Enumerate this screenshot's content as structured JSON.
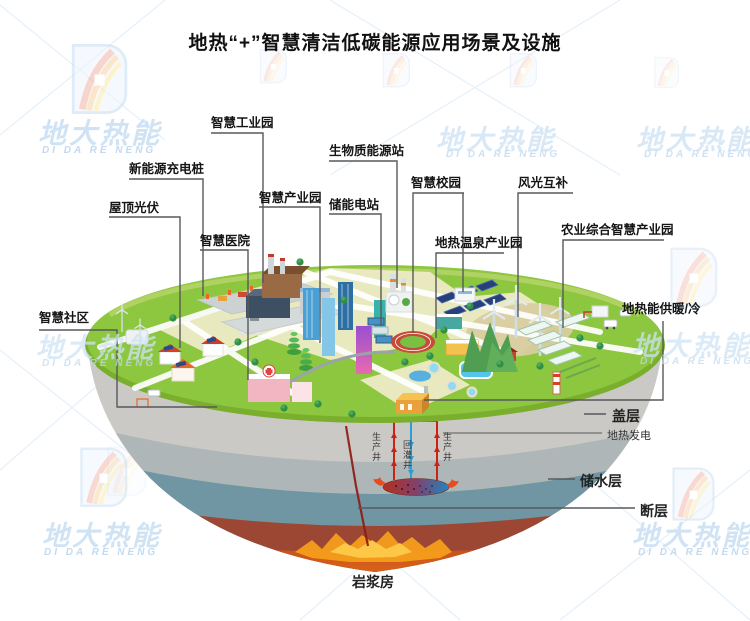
{
  "title": "地热“+”智慧清洁低碳能源应用场景及设施",
  "watermark": {
    "brand_cn": "地大热能",
    "brand_en": "DI DA RE NENG"
  },
  "callouts": {
    "industrial_park": "智慧工业园",
    "ev_charging": "新能源充电桩",
    "rooftop_pv": "屋顶光伏",
    "hospital": "智慧医院",
    "industry_park": "智慧产业园",
    "biomass_station": "生物质能源站",
    "storage_station": "储能电站",
    "campus": "智慧校园",
    "wind_solar": "风光互补",
    "hot_spring_park": "地热温泉产业园",
    "agriculture_park": "农业综合智慧产业园",
    "community": "智慧社区",
    "heating_cooling": "地热能供暖/冷"
  },
  "underground": {
    "cap_layer": "盖层",
    "geothermal_power": "地热发电",
    "aquifer": "储水层",
    "fault": "断层",
    "magma_chamber": "岩浆房",
    "production_well_left": "生产井",
    "reinjection_well": "回灌井",
    "production_well_right": "生产井"
  },
  "colors": {
    "surface_green": "#8DC63F",
    "cap_gray": "#CAC9C6",
    "aquifer_teal": "#6F96A2",
    "mantle_maroon": "#9C4734",
    "magma_orange": "#F09020",
    "production_well_red": "#CC2213",
    "reinjection_blue": "#2A9FD8",
    "leader_line": "#58595B",
    "watermark_blue": "#CFE3F5"
  }
}
